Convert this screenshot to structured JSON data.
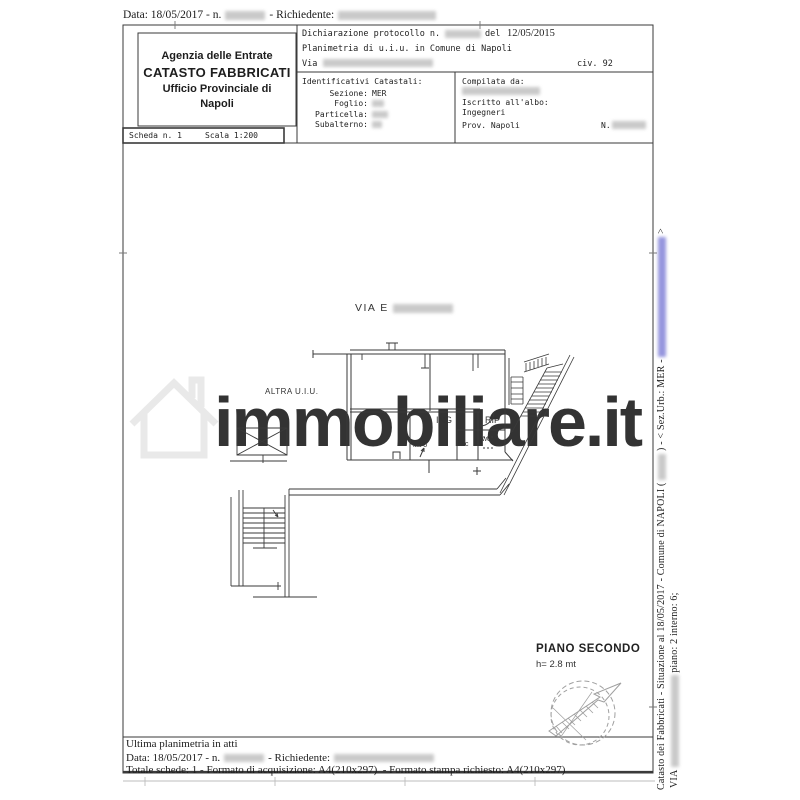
{
  "meta_top": {
    "date": "Data: 18/05/2017 - n.",
    "richiedente": "- Richiedente:"
  },
  "agency": {
    "line1": "Agenzia delle Entrate",
    "line2": "CATASTO FABBRICATI",
    "line3": "Ufficio Provinciale di",
    "line4": "Napoli"
  },
  "declaration": {
    "protocol": "Dichiarazione protocollo n.",
    "del": "del",
    "date": "12/05/2015",
    "object": "Planimetria di u.i.u. in Comune di Napoli",
    "via": "Via",
    "civ": "civ. 92"
  },
  "cadastral": {
    "title": "Identificativi Catastali:",
    "sezione_label": "Sezione:",
    "sezione_value": "MER",
    "foglio_label": "Foglio:",
    "particella_label": "Particella:",
    "subalterno_label": "Subalterno:",
    "compiled_by": "Compilata da:",
    "register": "Iscritto all'albo:",
    "register_value": "Ingegneri",
    "prov": "Prov. Napoli",
    "n_label": "N."
  },
  "sheet": {
    "scheda": "Scheda n. 1",
    "scala": "Scala 1:200"
  },
  "plan": {
    "street": "VIA E",
    "altra_uiu": "ALTRA U.I.U.",
    "room_ing": "ING",
    "room_rip": "RIP",
    "room_wc1": "wc",
    "room_wc2": "wc",
    "unit": "int 6",
    "floor": "PIANO SECONDO",
    "floor_height": "h= 2.8 mt"
  },
  "watermark": {
    "text": "immobiliare.it"
  },
  "sidebar": {
    "l1a": "Catasto dei Fabbricati - Situazione al 18/05/2017 - Comune di NAPOLI (",
    "l1b": ") - <  Sez.Urb.: MER -",
    "l1c": ">",
    "l2a": "VIA",
    "l2b": "piano: 2 interno: 6;"
  },
  "footer": {
    "ultima": "Ultima planimetria in atti",
    "date": "Data: 18/05/2017 - n.",
    "richiedente": "- Richiedente:",
    "totale": "Totale schede: 1 - Formato di acquisizione: A4(210x297)  - Formato stampa richiesto: A4(210x297)"
  },
  "colors": {
    "line": "#3a3a3a",
    "watermark": "#e9e9e9",
    "redaction": "#9e9e9e",
    "redaction_blue": "#5050c8",
    "compass": "#a0a0a0"
  }
}
